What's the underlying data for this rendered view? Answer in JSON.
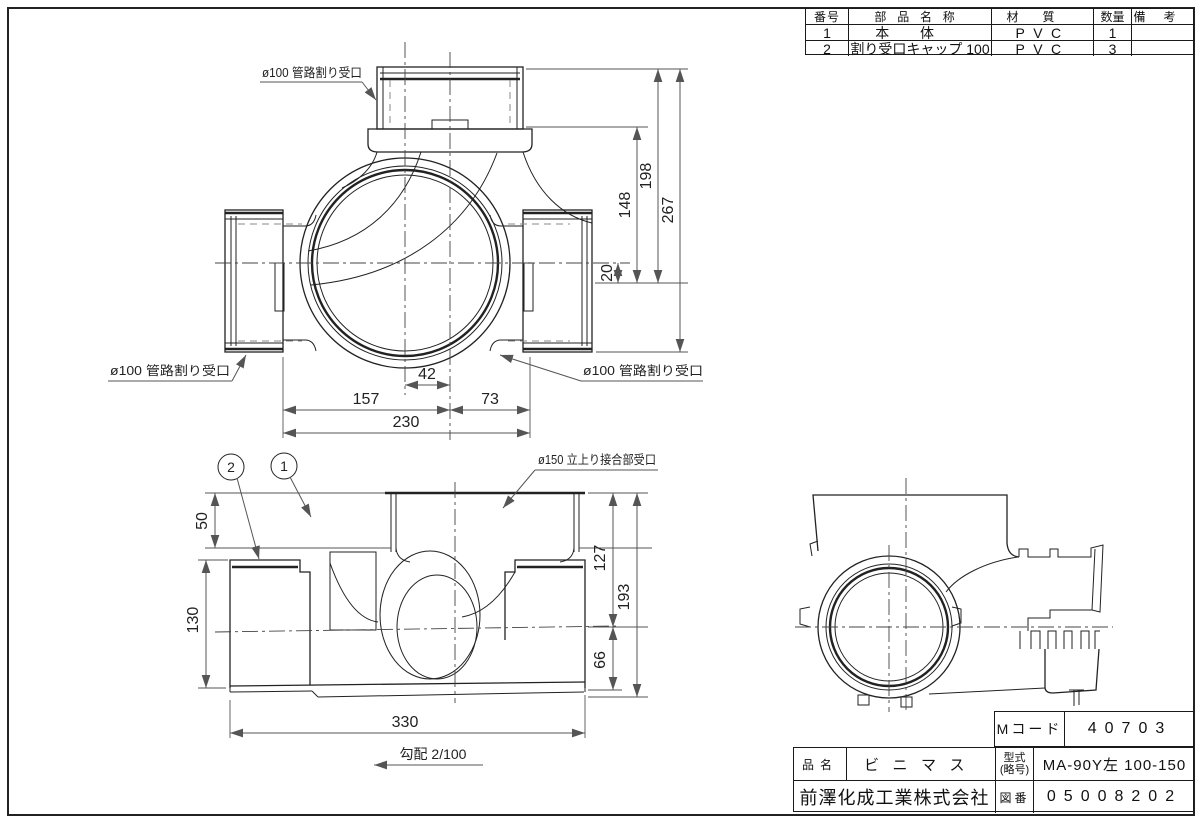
{
  "plan_view": {
    "callout_top": "ø100 管路割り受口",
    "callout_left": "ø100 管路割り受口",
    "callout_right": "ø100 管路割り受口",
    "dims": {
      "d42": "42",
      "d157": "157",
      "d73": "73",
      "d230": "230",
      "d20": "20",
      "d148": "148",
      "d198": "198",
      "d267": "267"
    }
  },
  "section_view": {
    "callout_riser": "ø150 立上り接合部受口",
    "balloons": {
      "b1": "1",
      "b2": "2"
    },
    "dims": {
      "d50": "50",
      "d130": "130",
      "d127": "127",
      "d193": "193",
      "d66": "66",
      "d330": "330"
    },
    "slope_note": "勾配 2/100"
  },
  "parts_table": {
    "headers": {
      "no": "番号",
      "name": "部品名称",
      "material": "材質",
      "qty": "数量",
      "remarks": "備考"
    },
    "rows": [
      {
        "no": "1",
        "name": "本体",
        "material": "PVC",
        "qty": "1",
        "remarks": ""
      },
      {
        "no": "2",
        "name": "割り受口キャップ 100",
        "material": "PVC",
        "qty": "3",
        "remarks": ""
      }
    ]
  },
  "title_block": {
    "m_code_label": "Mコード",
    "m_code_value": "40703",
    "product_name_label": "品名",
    "product_name_value": "ビニマス",
    "model_label_line1": "型式",
    "model_label_line2": "(略号)",
    "model_value": "MA-90Y左 100-150",
    "company_name": "前澤化成工業株式会社",
    "drawing_no_label": "図番",
    "drawing_no_value": "05008202"
  }
}
